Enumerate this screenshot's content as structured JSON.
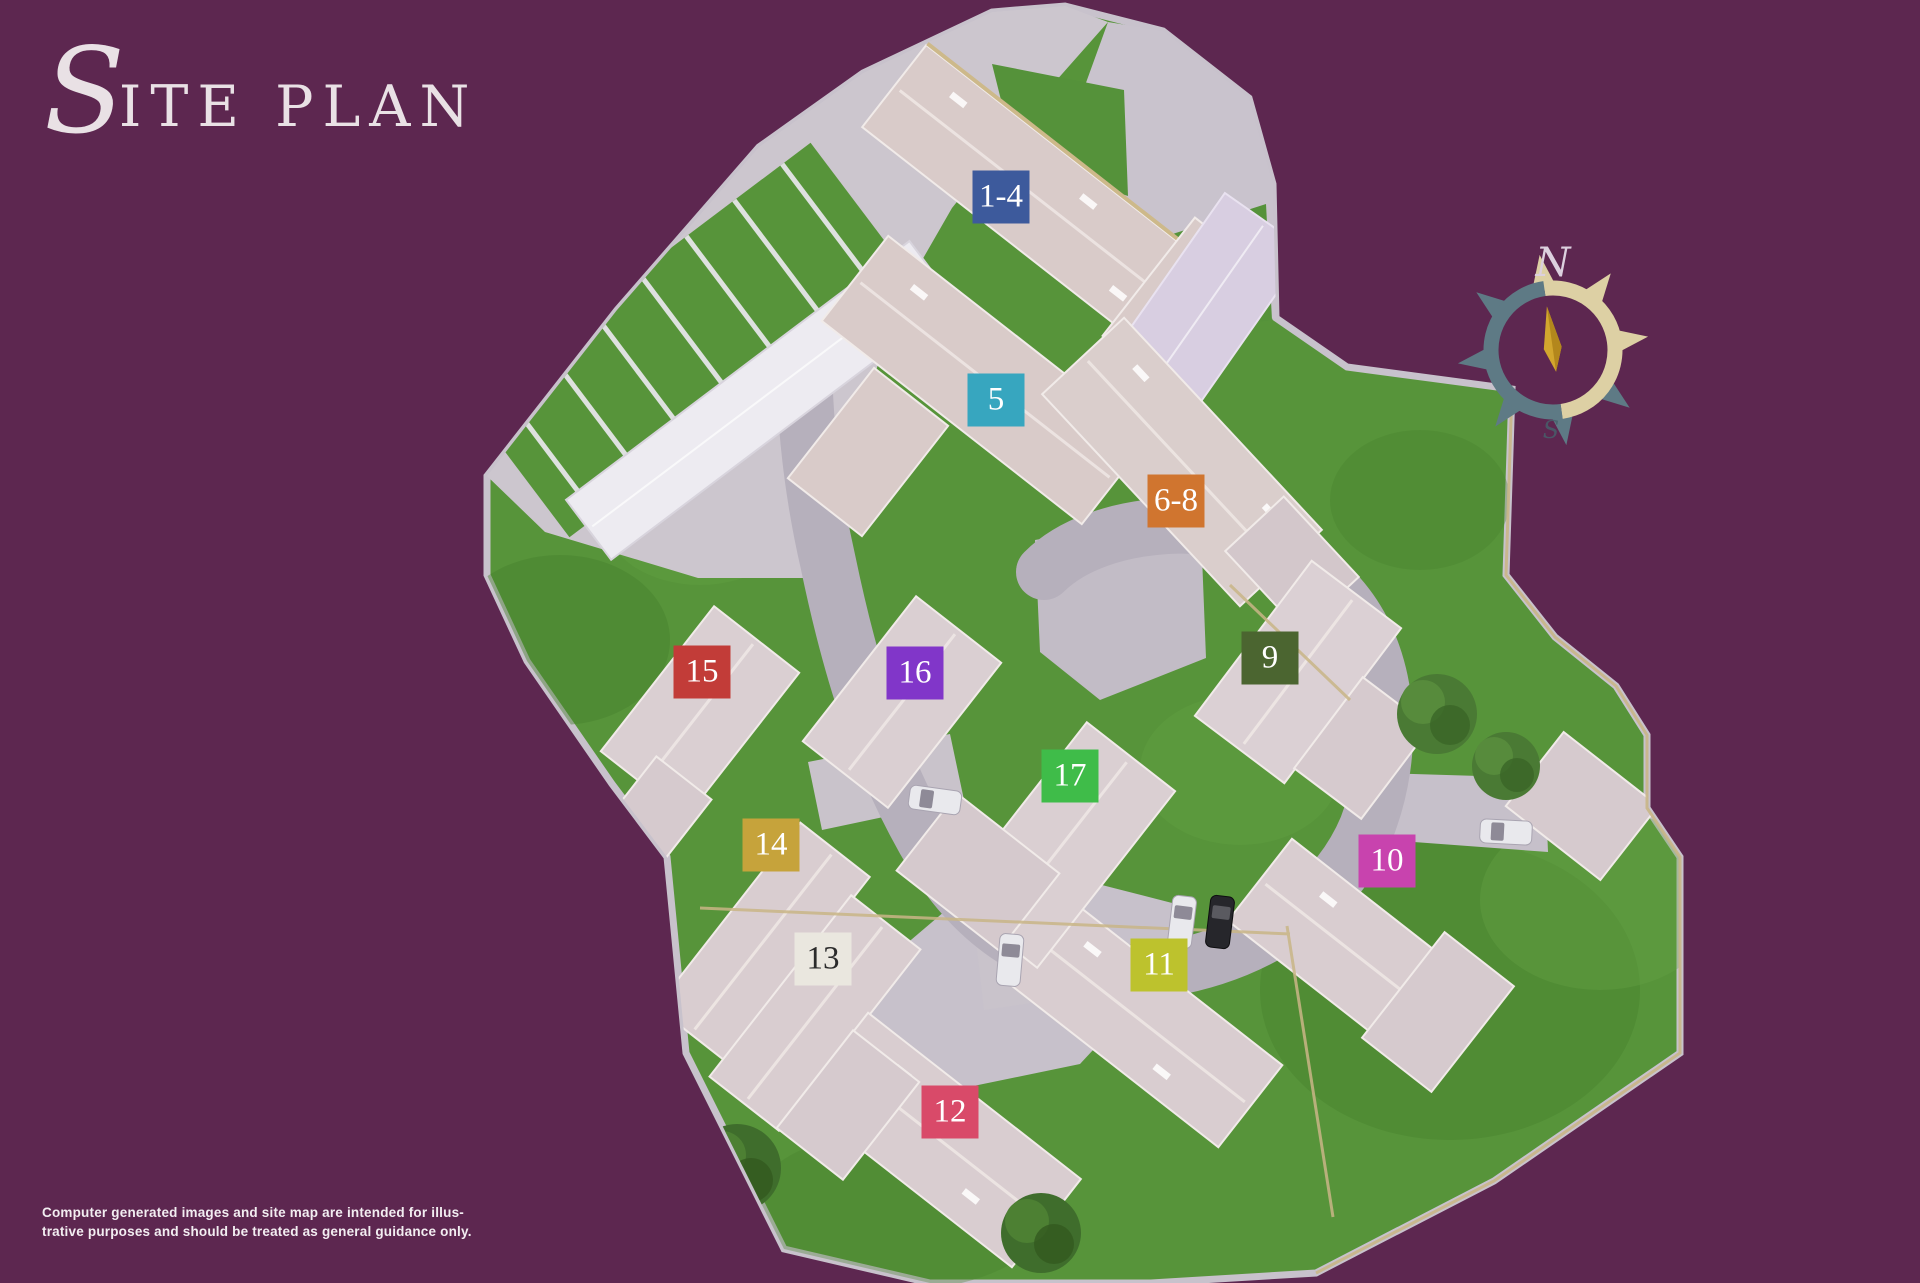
{
  "page": {
    "background_color": "#5d2750"
  },
  "title": {
    "initial": "S",
    "rest": "ITE PLAN"
  },
  "compass": {
    "north_label": "N",
    "south_label": "S"
  },
  "disclaimer": {
    "line1": "Computer generated images and site map are intended for illus-",
    "line2": "trative purposes and should be treated as general guidance only."
  },
  "plots": [
    {
      "label": "1-4",
      "color": "#3d5a9c",
      "text_color": "#ffffff",
      "x": 1001,
      "y": 197
    },
    {
      "label": "5",
      "color": "#37a6bf",
      "text_color": "#ffffff",
      "x": 996,
      "y": 400
    },
    {
      "label": "6-8",
      "color": "#d0752f",
      "text_color": "#ffffff",
      "x": 1176,
      "y": 501
    },
    {
      "label": "9",
      "color": "#4b6530",
      "text_color": "#ffffff",
      "x": 1270,
      "y": 658
    },
    {
      "label": "10",
      "color": "#c843ae",
      "text_color": "#ffffff",
      "x": 1387,
      "y": 861
    },
    {
      "label": "11",
      "color": "#bdc22d",
      "text_color": "#ffffff",
      "x": 1159,
      "y": 965
    },
    {
      "label": "12",
      "color": "#d94a69",
      "text_color": "#ffffff",
      "x": 950,
      "y": 1112
    },
    {
      "label": "13",
      "color": "#eae7df",
      "text_color": "#2b2b2b",
      "x": 823,
      "y": 959
    },
    {
      "label": "14",
      "color": "#c6a33b",
      "text_color": "#ffffff",
      "x": 771,
      "y": 845
    },
    {
      "label": "15",
      "color": "#c23c38",
      "text_color": "#ffffff",
      "x": 702,
      "y": 672
    },
    {
      "label": "16",
      "color": "#8136c9",
      "text_color": "#ffffff",
      "x": 915,
      "y": 673
    },
    {
      "label": "17",
      "color": "#3fbc49",
      "text_color": "#ffffff",
      "x": 1070,
      "y": 776
    }
  ]
}
